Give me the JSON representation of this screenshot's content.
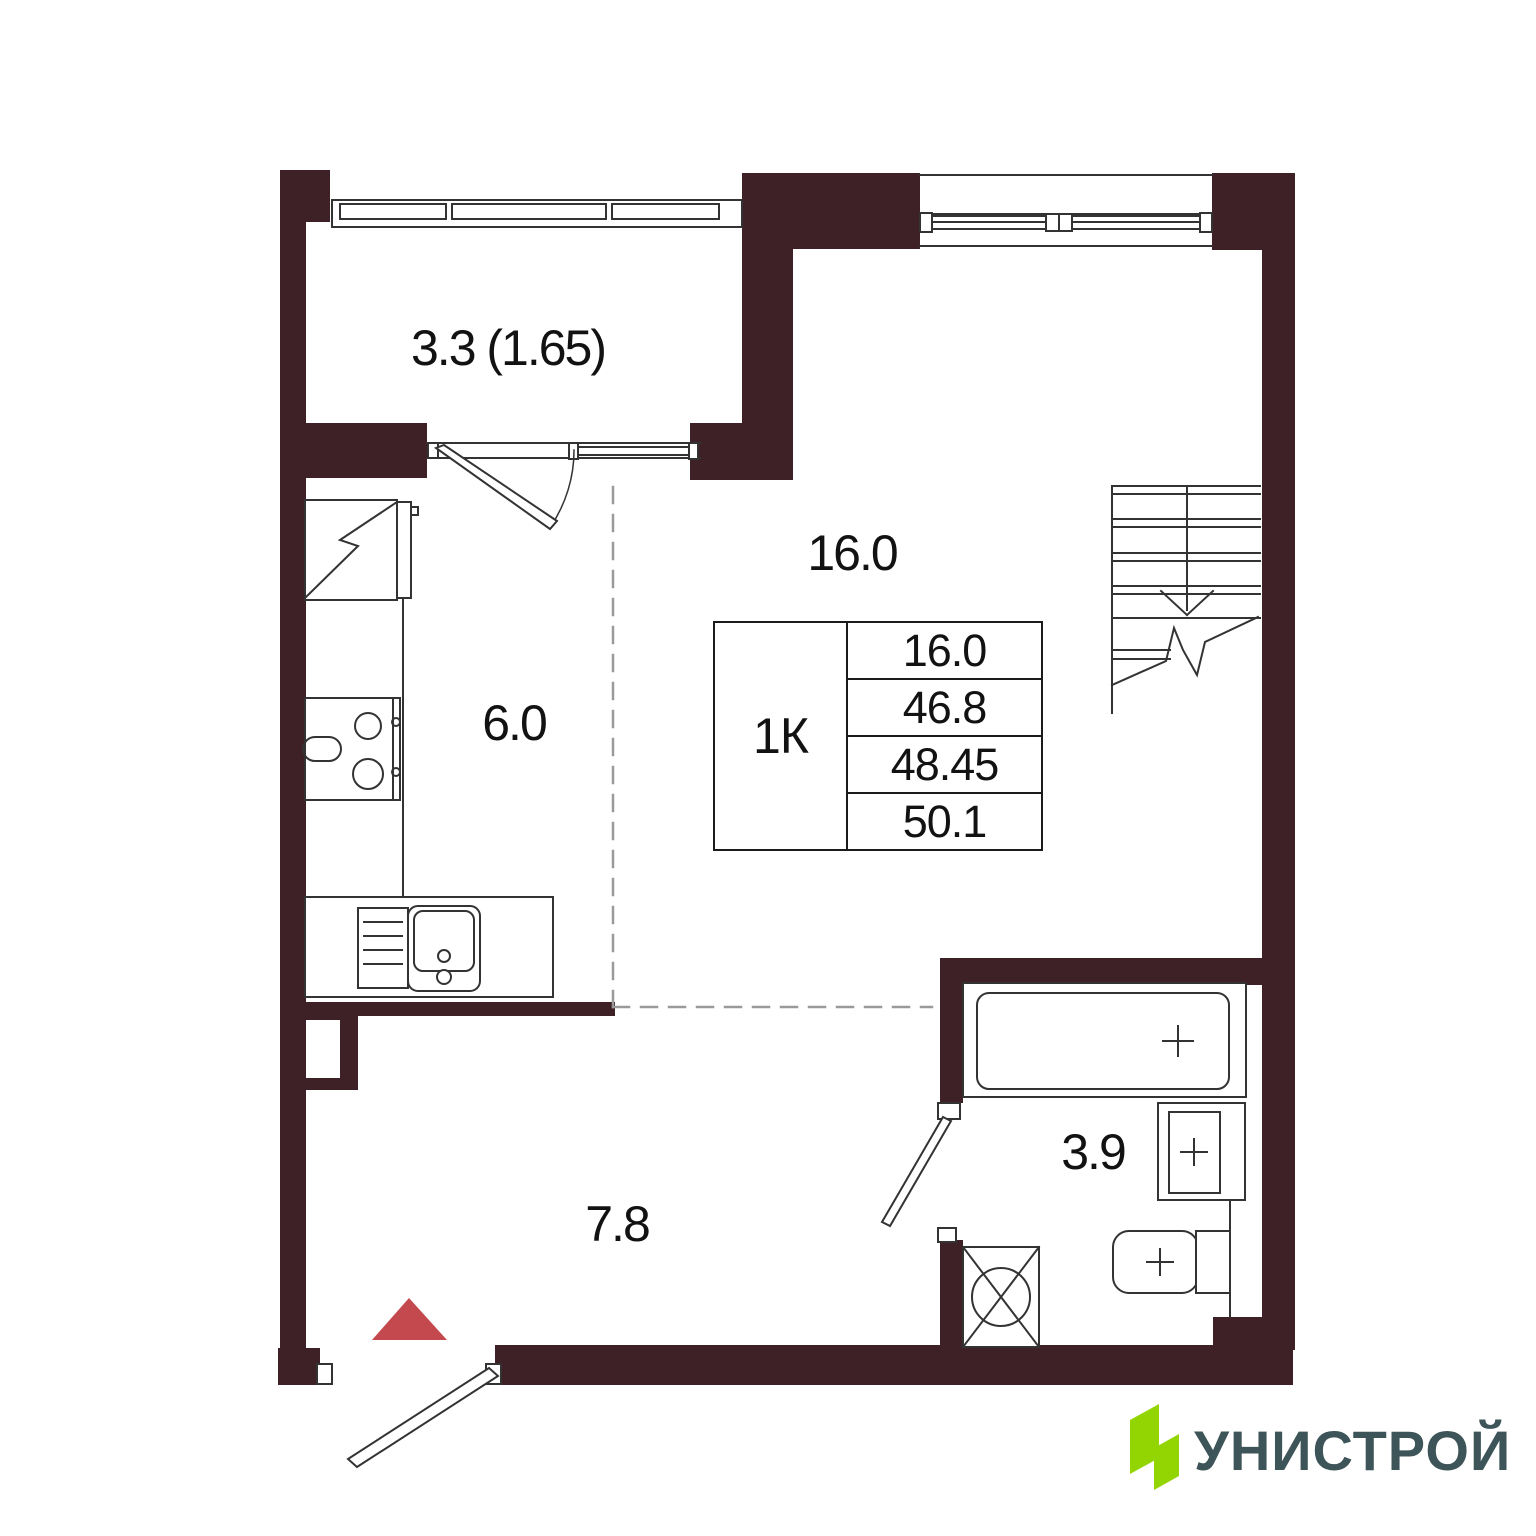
{
  "plan": {
    "rooms": {
      "balcony": {
        "area": "3.3 (1.65)"
      },
      "living": {
        "area": "16.0"
      },
      "kitchen": {
        "area": "6.0"
      },
      "hallway": {
        "area": "7.8"
      },
      "bathroom": {
        "area": "3.9"
      }
    },
    "spec_table": {
      "type": "1К",
      "values": [
        "16.0",
        "46.8",
        "48.45",
        "50.1"
      ]
    },
    "colors": {
      "wall": "#3E2126",
      "entry_arrow": "#C4494E",
      "logo_green": "#92D502",
      "logo_text": "#3D5458"
    }
  },
  "logo": {
    "brand": "УНИСТРОЙ"
  }
}
